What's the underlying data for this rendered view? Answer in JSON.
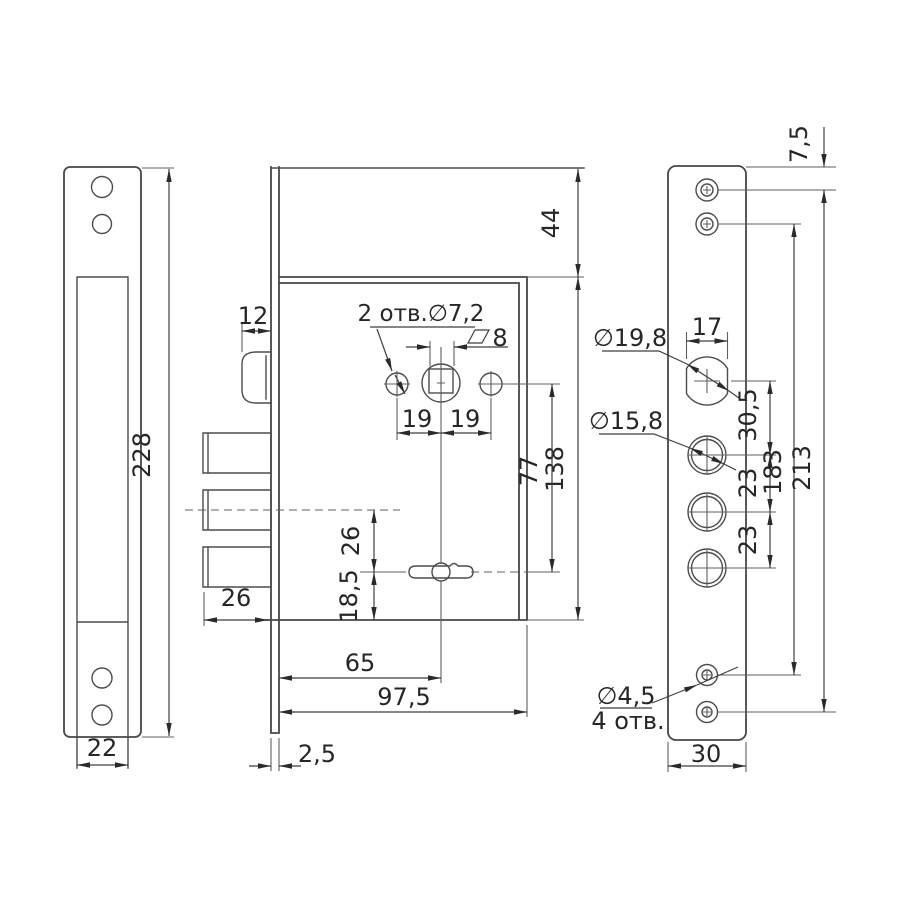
{
  "drawing": {
    "background": "#ffffff",
    "line_color": "#474747",
    "text_color": "#262626",
    "language": "ru",
    "views": {
      "strike_plate": {
        "height": "228",
        "width": "22"
      },
      "lock_body": {
        "latch_width": "12",
        "holes_label": "2 отв.∅7,2",
        "square_size": "8",
        "hole_offset_left": "19",
        "hole_offset_right": "19",
        "top_offset": "44",
        "handle_to_key": "77",
        "body_height": "138",
        "bolt_to_key": "26",
        "key_to_bottom": "18,5",
        "bolt_length": "26",
        "backset": "65",
        "body_depth": "97,5",
        "faceplate_thickness": "2,5"
      },
      "faceplate": {
        "top_screw_offset": "7,5",
        "cylinder_width": "17",
        "cylinder_dia": "∅19,8",
        "bolt_hole_dia": "∅15,8",
        "cyl_to_bolt": "30,5",
        "bolt_spacing_1": "23",
        "bolt_spacing_2": "23",
        "screw_span_inner": "183",
        "screw_span_outer": "213",
        "screw_dia": "∅4,5",
        "screw_count": "4 отв.",
        "width": "30"
      }
    }
  }
}
